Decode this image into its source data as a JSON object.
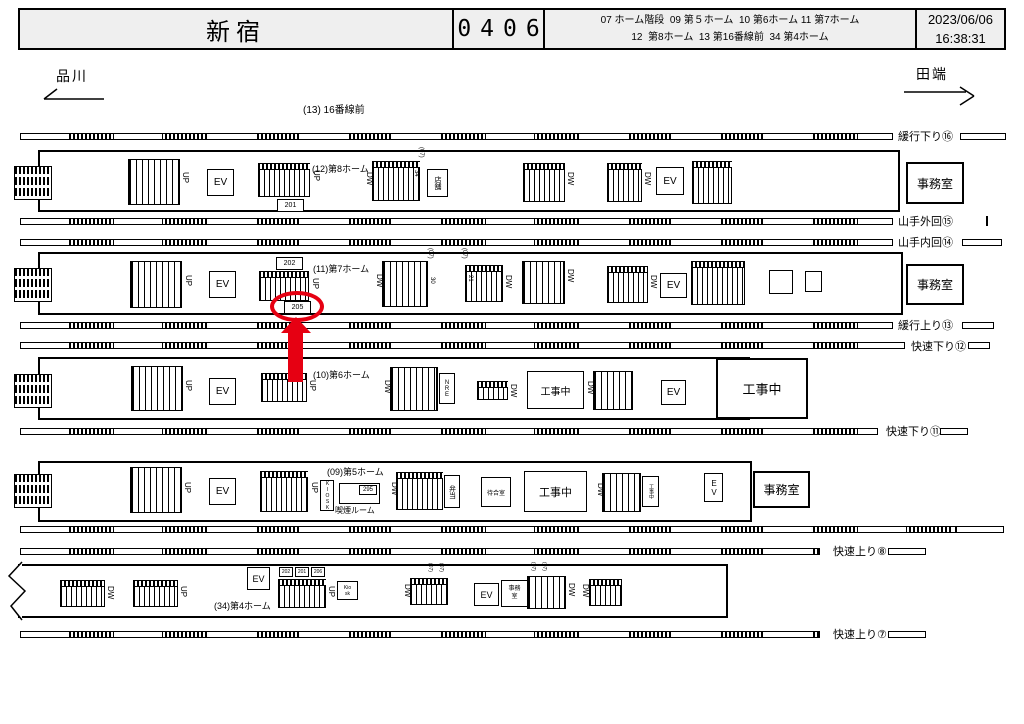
{
  "header": {
    "station": "新宿",
    "code": "0406",
    "legend_line1": "07 ホーム階段  09 第５ホーム  10 第6ホーム 11 第7ホーム",
    "legend_line2": "12  第8ホーム  13 第16番線前  34 第4ホーム",
    "date": "2023/06/06",
    "time": "16:38:31"
  },
  "nav": {
    "left_station": "品川",
    "right_station": "田端"
  },
  "area_label": "(13) 16番線前",
  "common": {
    "up": "UP",
    "down": "DW",
    "elevator": "EV",
    "office": "事務室",
    "under_construction": "工事中",
    "stair_tag": "(07)"
  },
  "tracks": [
    {
      "label": "緩行下り⑯"
    },
    {
      "label": "山手外回⑮"
    },
    {
      "label": "山手内回⑭"
    },
    {
      "label": "緩行上り⑬"
    },
    {
      "label": "快速下り⑫"
    },
    {
      "label": "快速下り⑪"
    },
    {
      "label": "快速上り⑧"
    },
    {
      "label": "快速上り⑦"
    }
  ],
  "platform8": {
    "name": "(12)第8ホーム",
    "escalator_no": "201",
    "area_tag": "34",
    "shop": "店舗"
  },
  "platform7": {
    "name": "(11)第7ホーム",
    "escalator_no_top": "202",
    "highlighted_no": "205",
    "stair_no": "30",
    "escalator_no_side": "21"
  },
  "platform6": {
    "name": "(10)第6ホーム",
    "nre": "NRE"
  },
  "platform5": {
    "name": "(09)第5ホーム",
    "kiosk": "KIOSK",
    "smoking_no": "295",
    "smoking_label": "喫煙ルーム",
    "bento": "弁当",
    "waiting_room": "待合室"
  },
  "platform4": {
    "name": "(34)第4ホーム",
    "board_no_1": "202",
    "board_no_2": "201",
    "board_no_3": "206",
    "kiosk_line1": "Kio",
    "kiosk_line2": "sk",
    "office_line1": "事務",
    "office_line2": "室"
  }
}
